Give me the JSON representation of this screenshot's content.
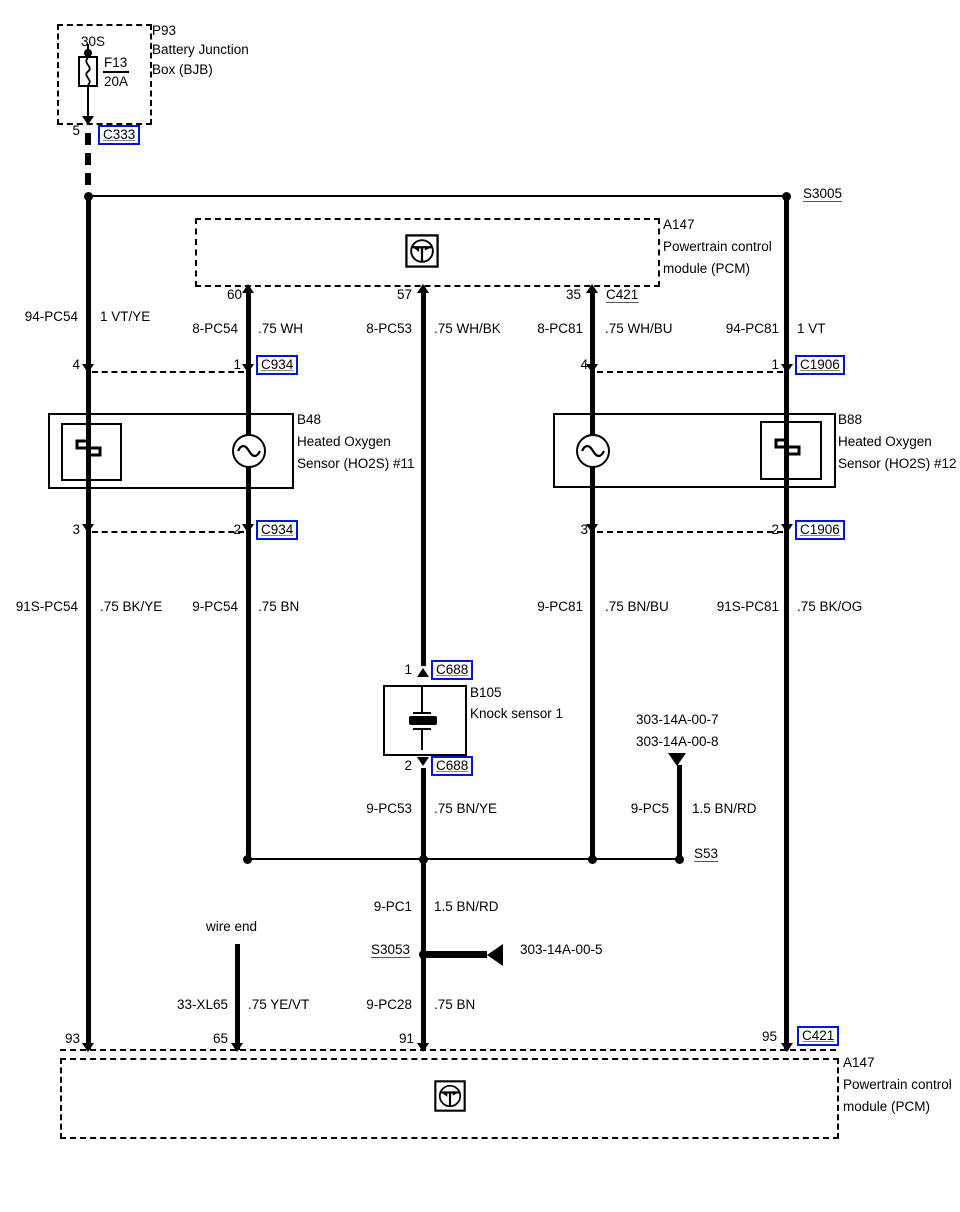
{
  "colors": {
    "connector_blue": "#0018d6",
    "wire_black": "#000000"
  },
  "battery_junction_box": {
    "id": "P93",
    "name_line1": "Battery Junction",
    "name_line2": "Box (BJB)",
    "bus": "30S",
    "fuse_name": "F13",
    "fuse_rating": "20A",
    "pin": "5",
    "connector": "C333"
  },
  "pcm_top": {
    "id": "A147",
    "name_line1": "Powertrain control",
    "name_line2": "module (PCM)",
    "pin_left": "60",
    "pin_mid": "57",
    "pin_right": "35",
    "connector": "C421"
  },
  "pcm_bottom": {
    "id": "A147",
    "name_line1": "Powertrain control",
    "name_line2": "module (PCM)",
    "pin_93": "93",
    "pin_65": "65",
    "pin_91": "91",
    "pin_95": "95",
    "connector": "C421"
  },
  "ho2s11": {
    "id": "B48",
    "name_line1": "Heated Oxygen",
    "name_line2": "Sensor (HO2S) #11",
    "pin_top_left": "4",
    "pin_top_right": "1",
    "pin_bottom_left": "3",
    "pin_bottom_right": "2"
  },
  "ho2s12": {
    "id": "B88",
    "name_line1": "Heated Oxygen",
    "name_line2": "Sensor (HO2S) #12",
    "pin_top_left": "4",
    "pin_top_right": "1",
    "pin_bottom_left": "3",
    "pin_bottom_right": "2"
  },
  "knock_sensor": {
    "id": "B105",
    "name": "Knock sensor 1",
    "pin_top": "1",
    "pin_bottom": "2"
  },
  "connectors": {
    "c333": "C333",
    "c934": "C934",
    "c1906": "C1906",
    "c688": "C688",
    "c421": "C421"
  },
  "splices": {
    "s3005": "S3005",
    "s53": "S53",
    "s3053": "S3053"
  },
  "references": {
    "knock_a": "303-14A-00-7",
    "knock_b": "303-14A-00-8",
    "ground": "303-14A-00-5"
  },
  "wire_end_label": "wire end",
  "wires": {
    "vt_ye": {
      "circuit": "94-PC54",
      "spec": "1 VT/YE"
    },
    "wh": {
      "circuit": "8-PC54",
      "spec": ".75 WH"
    },
    "wh_bk": {
      "circuit": "8-PC53",
      "spec": ".75 WH/BK"
    },
    "wh_bu": {
      "circuit": "8-PC81",
      "spec": ".75 WH/BU"
    },
    "vt": {
      "circuit": "94-PC81",
      "spec": "1 VT"
    },
    "bk_ye": {
      "circuit": "91S-PC54",
      "spec": ".75 BK/YE"
    },
    "bn_b": {
      "circuit": "9-PC54",
      "spec": ".75 BN"
    },
    "bn_bu": {
      "circuit": "9-PC81",
      "spec": ".75 BN/BU"
    },
    "bk_og": {
      "circuit": "91S-PC81",
      "spec": ".75 BK/OG"
    },
    "bn_ye": {
      "circuit": "9-PC53",
      "spec": ".75 BN/YE"
    },
    "bn_rd_5": {
      "circuit": "9-PC5",
      "spec": "1.5 BN/RD"
    },
    "bn_rd_1": {
      "circuit": "9-PC1",
      "spec": "1.5 BN/RD"
    },
    "ye_vt": {
      "circuit": "33-XL65",
      "spec": ".75 YE/VT"
    },
    "bn_c": {
      "circuit": "9-PC28",
      "spec": ".75 BN"
    }
  }
}
